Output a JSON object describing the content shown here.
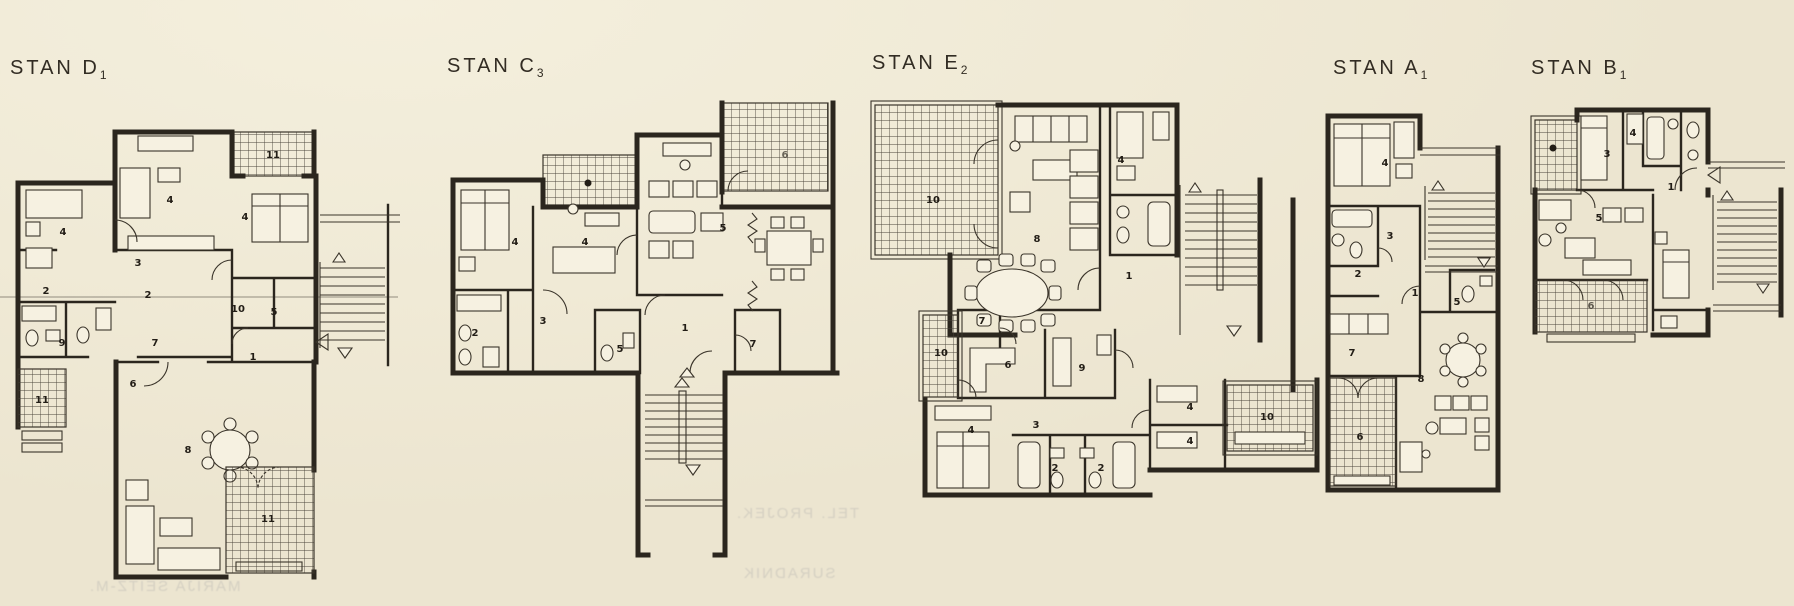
{
  "paper": {
    "background": "#f0ead6",
    "ink": "#2b261e",
    "ghost_ink": "#5f647d"
  },
  "plans": [
    {
      "id": "d1",
      "name": "STAN D",
      "sub": "1",
      "rooms": [
        "11",
        "4",
        "4",
        "4",
        "3",
        "2",
        "2",
        "10",
        "5",
        "9",
        "7",
        "1",
        "6",
        "8",
        "11",
        "11"
      ]
    },
    {
      "id": "c3",
      "name": "STAN C",
      "sub": "3",
      "rooms": [
        "4",
        "4",
        "5",
        "6",
        "2",
        "3",
        "5",
        "1",
        "7"
      ]
    },
    {
      "id": "e2",
      "name": "STAN E",
      "sub": "2",
      "rooms": [
        "10",
        "8",
        "4",
        "1",
        "7",
        "10",
        "6",
        "9",
        "3",
        "4",
        "2",
        "2",
        "4",
        "4",
        "10"
      ]
    },
    {
      "id": "a1",
      "name": "STAN A",
      "sub": "1",
      "rooms": [
        "4",
        "3",
        "2",
        "1",
        "5",
        "7",
        "8",
        "6"
      ]
    },
    {
      "id": "b1",
      "name": "STAN B",
      "sub": "1",
      "rooms": [
        "3",
        "4",
        "1",
        "5",
        "6"
      ]
    }
  ],
  "ghost_text": [
    "TEL. PROJEK.",
    "SURADNIK",
    "MARIJA SEITZ-M."
  ]
}
